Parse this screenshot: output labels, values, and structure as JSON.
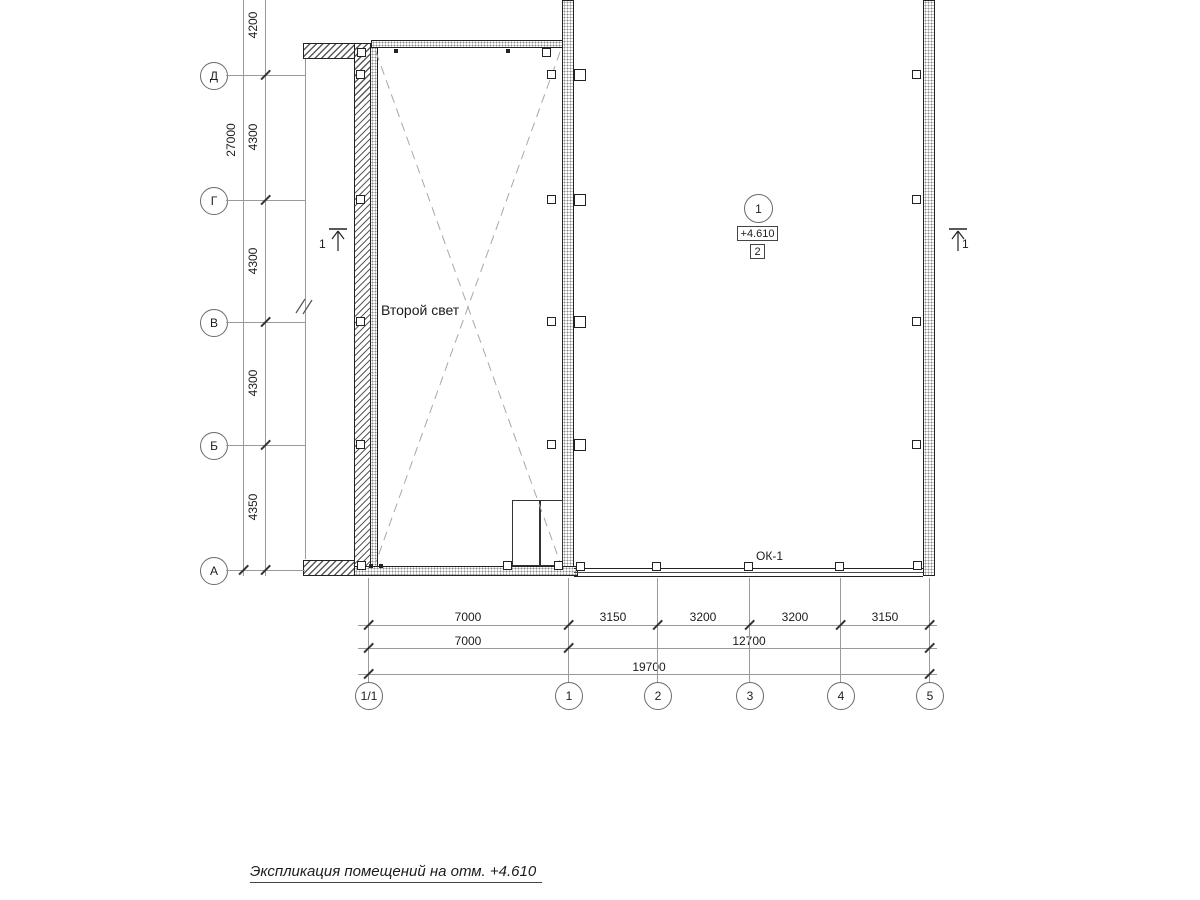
{
  "axes": {
    "vertical": [
      "Д",
      "Г",
      "В",
      "Б",
      "А"
    ],
    "horizontal": [
      "1/1",
      "1",
      "2",
      "3",
      "4",
      "5"
    ]
  },
  "dims": {
    "overall_left": "27000",
    "left_segments": [
      "4200",
      "4300",
      "4300",
      "4300",
      "4350"
    ],
    "row1": [
      "7000",
      "3150",
      "3200",
      "3200",
      "3150"
    ],
    "row2": [
      "7000",
      "12700"
    ],
    "row3": [
      "19700"
    ]
  },
  "labels": {
    "second_light": "Второй свет",
    "window_mark": "ОК-1",
    "title": "Экспликация помещений на отм. +4.610"
  },
  "room_marker": {
    "number": "1",
    "elevation": "+4.610",
    "ref": "2"
  },
  "section_marks": {
    "left": "1",
    "right": "1"
  }
}
